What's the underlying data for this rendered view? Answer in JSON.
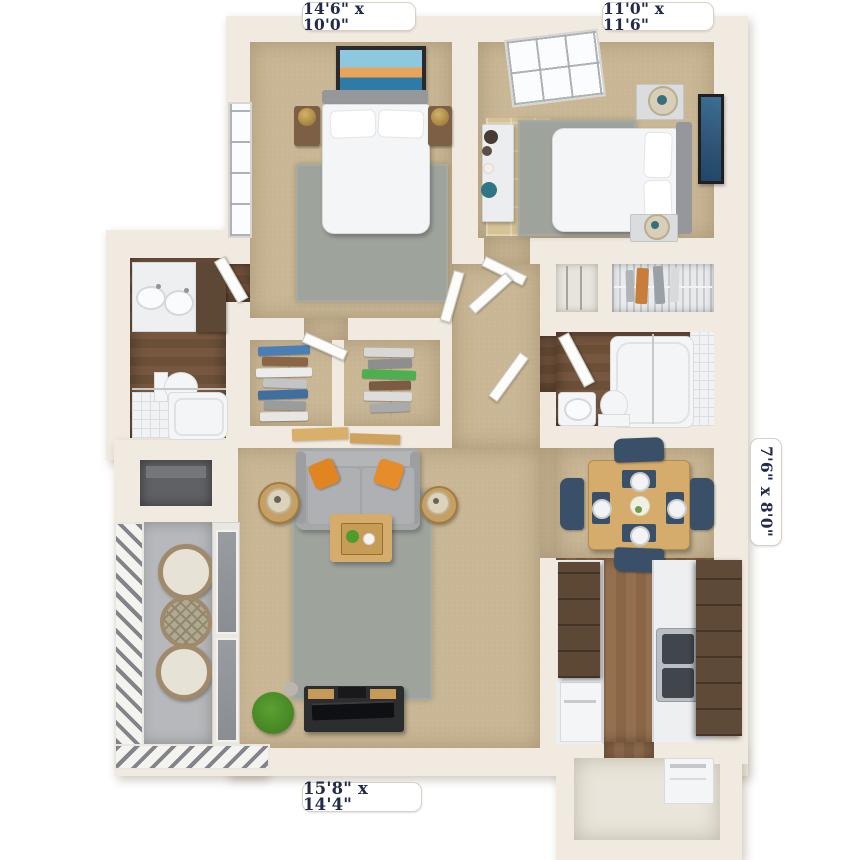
{
  "title": "Two-bedroom apartment 3D floor plan",
  "labels": {
    "bedroom1_dims": "14'6\" x 10'0\"",
    "bedroom2_dims": "11'0\" x 11'6\"",
    "dining_dims": "7'6\" x 8'0\"",
    "living_dims": "15'8\" x 14'4\""
  },
  "colors": {
    "wall": "#f0eae0",
    "carpet": "#c8b694",
    "rug": "#9ea39c",
    "label_text": "#232a4a",
    "label_bg": "#ffffff",
    "chair_navy": "#3a5068",
    "cabinet_brown": "#5d4836",
    "counter_white": "#edeff0",
    "sofa_gray": "#a6a8aa",
    "accent_orange": "#e08522",
    "table_wood": "#d5ac6c",
    "art_navy": "#2e5374",
    "lamp_teal": "#36707e",
    "balcony_gray": "#b7b8bb",
    "wood_floor_dark": "#6b4f37",
    "wood_floor_mid": "#8a6647"
  }
}
